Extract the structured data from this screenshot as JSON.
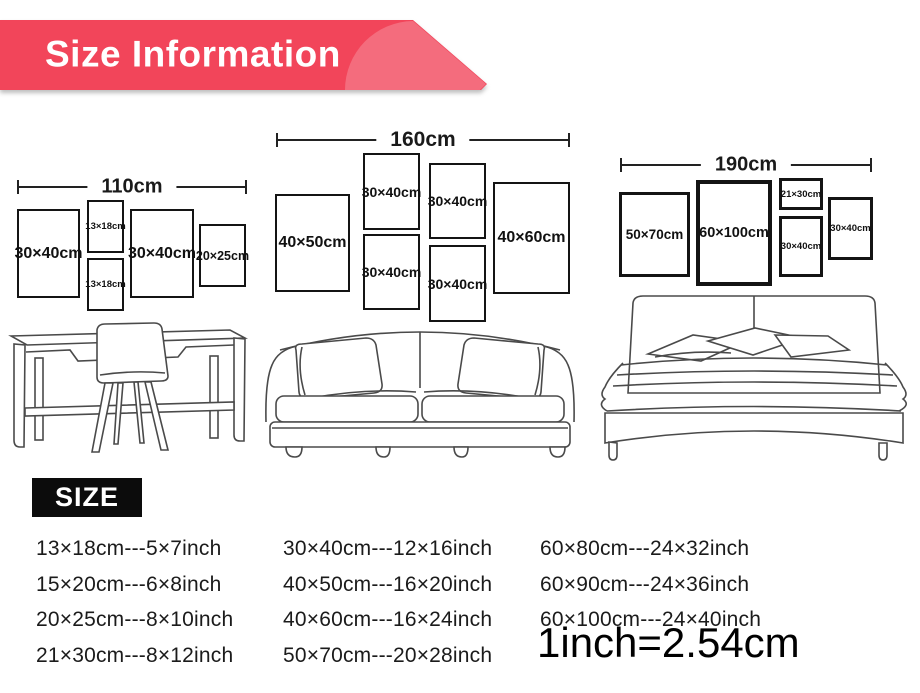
{
  "banner": {
    "title": "Size Information",
    "main_color": "#f2455a",
    "highlight_color": "#f46c7d"
  },
  "layouts": [
    {
      "id": "desk-wall",
      "total_width": "110cm",
      "furniture": "desk-and-chair",
      "frames": [
        {
          "label": "30×40cm"
        },
        {
          "label": "13×18cm"
        },
        {
          "label": "13×18cm"
        },
        {
          "label": "30×40cm"
        },
        {
          "label": "20×25cm"
        }
      ]
    },
    {
      "id": "sofa-wall",
      "total_width": "160cm",
      "furniture": "sofa",
      "frames": [
        {
          "label": "40×50cm"
        },
        {
          "label": "30×40cm"
        },
        {
          "label": "30×40cm"
        },
        {
          "label": "30×40cm"
        },
        {
          "label": "30×40cm"
        },
        {
          "label": "40×60cm"
        }
      ]
    },
    {
      "id": "bed-wall",
      "total_width": "190cm",
      "furniture": "bed",
      "frames": [
        {
          "label": "50×70cm"
        },
        {
          "label": "60×100cm"
        },
        {
          "label": "21×30cm"
        },
        {
          "label": "30×40cm"
        },
        {
          "label": "30×40cm"
        }
      ]
    }
  ],
  "size_section": {
    "heading": "SIZE",
    "conversions": [
      [
        "13×18cm---5×7inch",
        "15×20cm---6×8inch",
        "20×25cm---8×10inch",
        "21×30cm---8×12inch"
      ],
      [
        "30×40cm---12×16inch",
        "40×50cm---16×20inch",
        "40×60cm---16×24inch",
        "50×70cm---20×28inch"
      ],
      [
        "60×80cm---24×32inch",
        "60×90cm---24×36inch",
        "60×100cm---24×40inch"
      ]
    ],
    "note": "1inch=2.54cm"
  }
}
